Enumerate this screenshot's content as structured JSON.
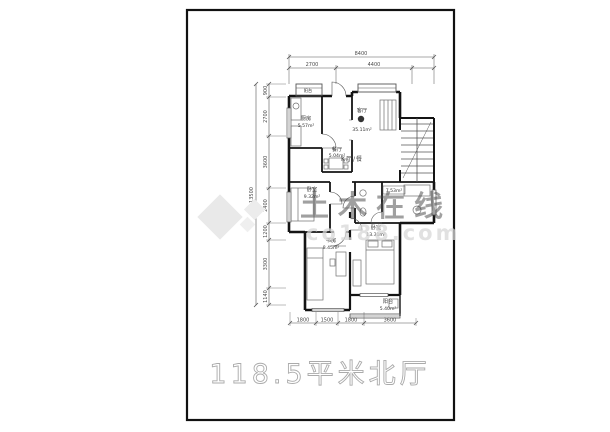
{
  "plan": {
    "title": "118.5平米北厅",
    "rooms": {
      "balcony_top": {
        "name": "阳台"
      },
      "kitchen": {
        "name": "厨房",
        "area": "5.57m²"
      },
      "dining": {
        "name": "餐厅",
        "area": "5.04m²"
      },
      "living": {
        "name": "客厅",
        "area": "35.11m²"
      },
      "hall": {
        "name": "K厅/餐"
      },
      "bedroom_left": {
        "name": "卧室",
        "area": "9.32m²"
      },
      "bath": {
        "area": "7.53m²"
      },
      "study": {
        "name": "书房",
        "area": "8.45m²"
      },
      "bedroom_right": {
        "name": "卧室",
        "area": "13.31m²"
      },
      "balcony_bottom": {
        "name": "阳台",
        "area": "5.40m²"
      }
    },
    "dimensions": {
      "top_total": "8400",
      "top_a": "2700",
      "top_b": "4400",
      "left_total": "13500",
      "left_1": "900",
      "left_2": "2700",
      "left_3": "3600",
      "left_4": "2400",
      "left_5": "1200",
      "left_6": "3300",
      "left_7": "1140",
      "bottom_1": "1800",
      "bottom_2": "1500",
      "bottom_3": "1800",
      "bottom_4": "3600"
    },
    "watermark": {
      "brand": "土木在线",
      "site": "co188.com"
    },
    "colors": {
      "accent": "#e59a63",
      "watermark_grey": "#e9e9e9",
      "title_outline": "#ababab",
      "wall": "#141414"
    }
  }
}
